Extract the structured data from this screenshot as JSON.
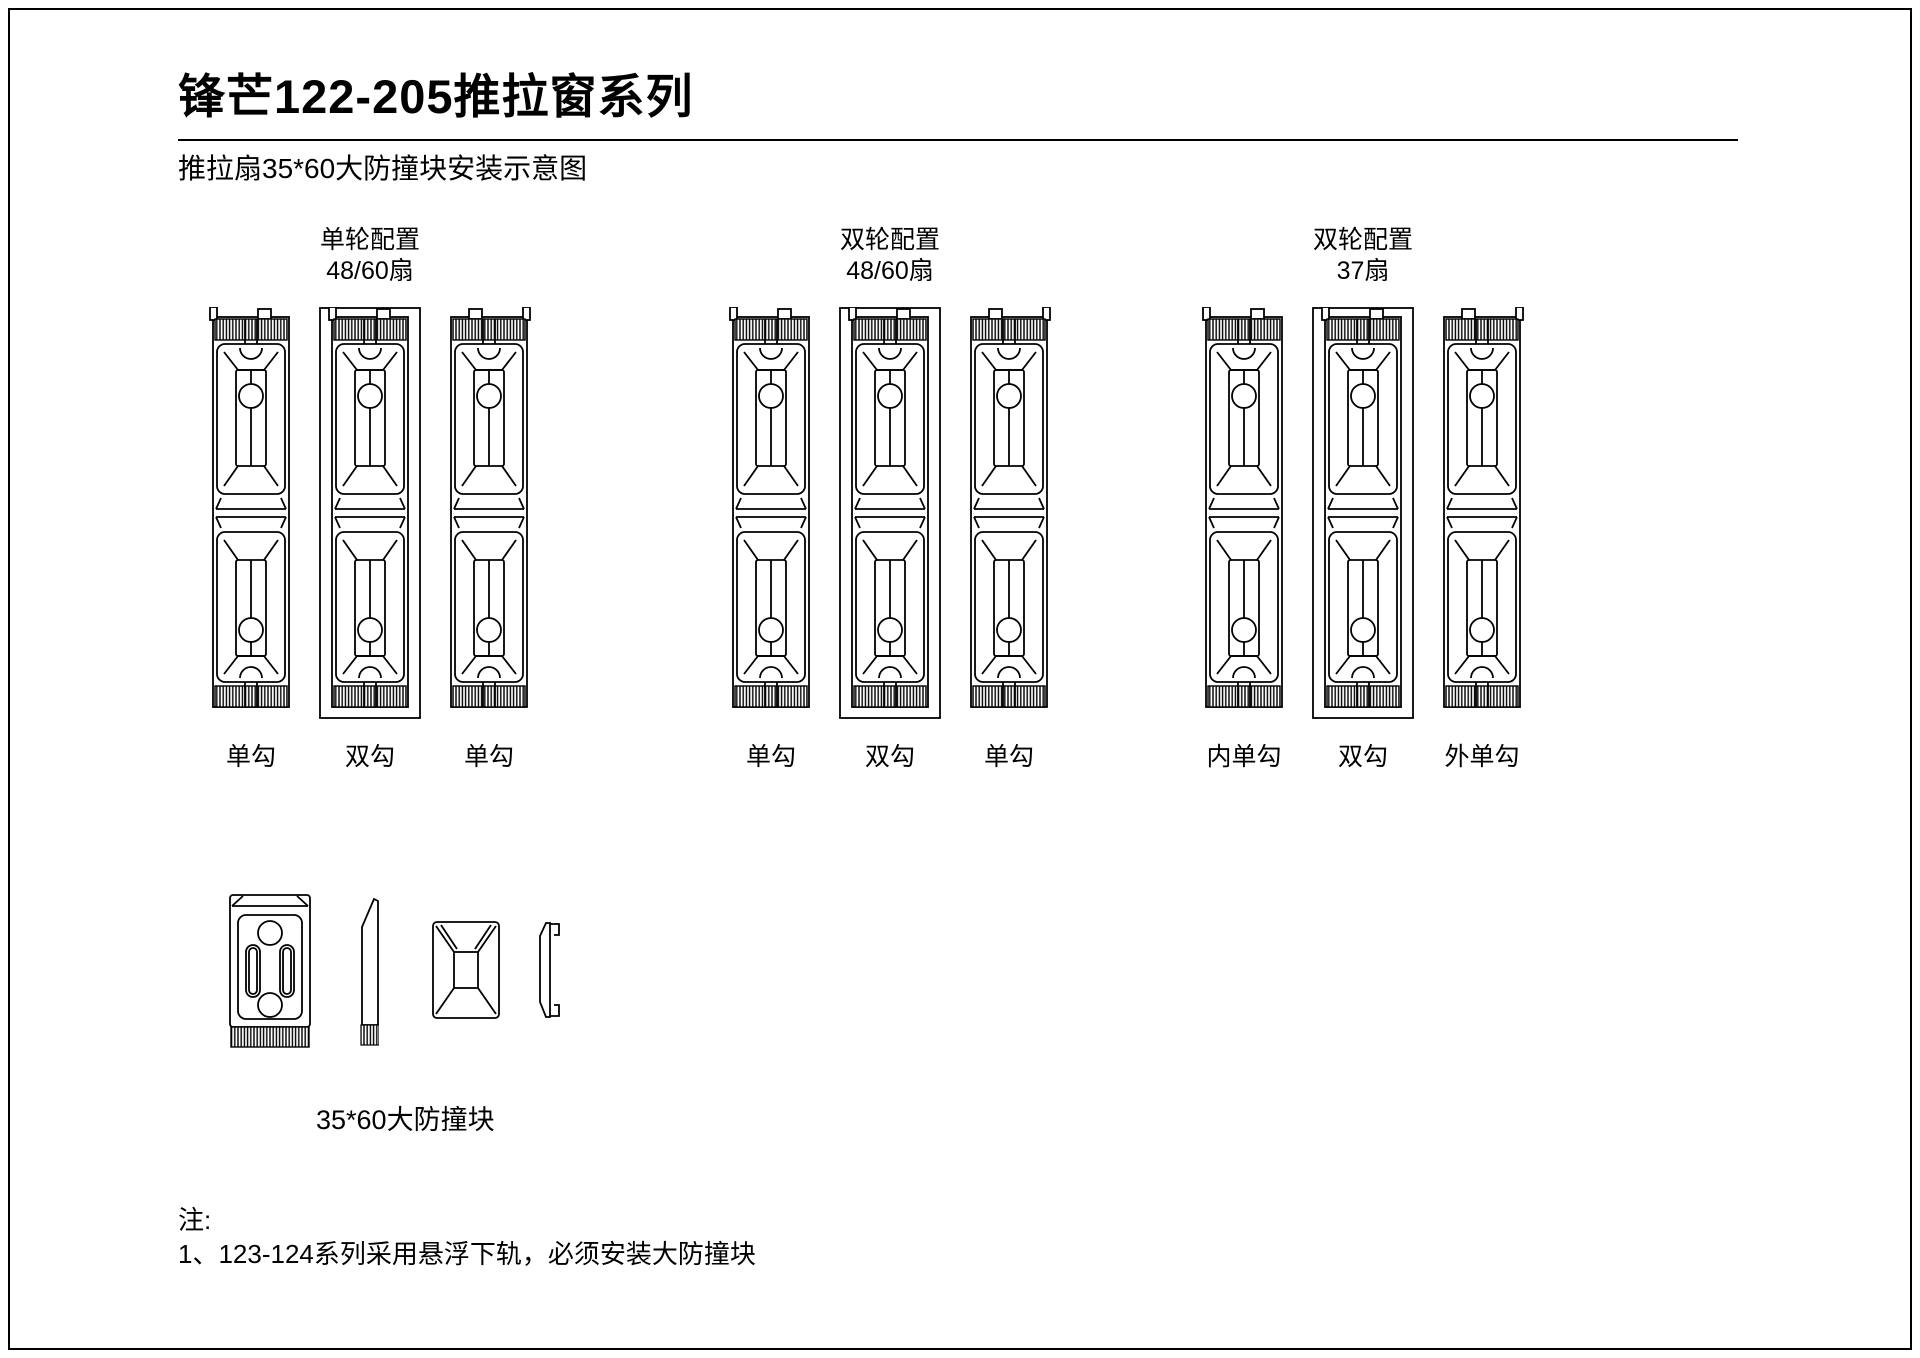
{
  "page": {
    "title": "锋芒122-205推拉窗系列",
    "subtitle": "推拉扇35*60大防撞块安装示意图"
  },
  "groups": [
    {
      "config": "单轮配置",
      "sash": "48/60扇",
      "profiles": [
        {
          "hook": "单勾",
          "type": "single"
        },
        {
          "hook": "双勾",
          "type": "double"
        },
        {
          "hook": "单勾",
          "type": "single-mirrored"
        }
      ]
    },
    {
      "config": "双轮配置",
      "sash": "48/60扇",
      "profiles": [
        {
          "hook": "单勾",
          "type": "single"
        },
        {
          "hook": "双勾",
          "type": "double"
        },
        {
          "hook": "单勾",
          "type": "single-mirrored"
        }
      ]
    },
    {
      "config": "双轮配置",
      "sash": "37扇",
      "profiles": [
        {
          "hook": "内单勾",
          "type": "single"
        },
        {
          "hook": "双勾",
          "type": "double"
        },
        {
          "hook": "外单勾",
          "type": "single-mirrored"
        }
      ]
    }
  ],
  "part": {
    "label": "35*60大防撞块"
  },
  "notes": {
    "heading": "注:",
    "items": [
      "1、123-124系列采用悬浮下轨，必须安装大防撞块"
    ]
  },
  "colors": {
    "ink": "#000000",
    "background": "#ffffff"
  }
}
